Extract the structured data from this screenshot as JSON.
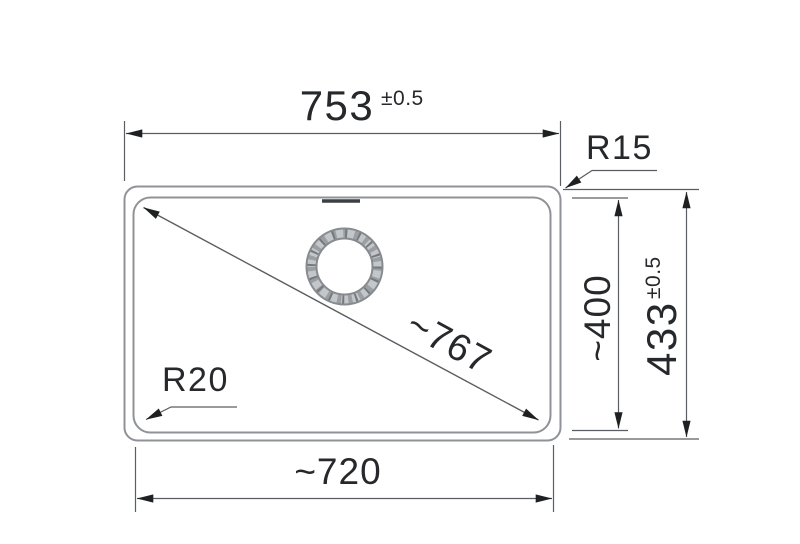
{
  "drawing": {
    "labels": {
      "width_top": {
        "value": "753",
        "tolerance": "±0.5"
      },
      "corner_radius_top_right": "R15",
      "height_inner": "~400",
      "height_outer": {
        "value": "433",
        "tolerance": "±0.5"
      },
      "diagonal": "~767",
      "corner_radius_bottom_left": "R20",
      "width_bottom": "~720"
    },
    "colors": {
      "background": "#ffffff",
      "sink_outline": "#8f9397",
      "dimension_lines": "#5a5e62",
      "arrowheads": "#1e2022",
      "text": "#26282b",
      "overflow_mark": "#3b3f43",
      "drain_ring_light": "#c3c7ca",
      "drain_ring_mid": "#9b9fa3",
      "drain_ring_dark": "#74797d",
      "drain_ring_edge": "#878b8f"
    }
  }
}
